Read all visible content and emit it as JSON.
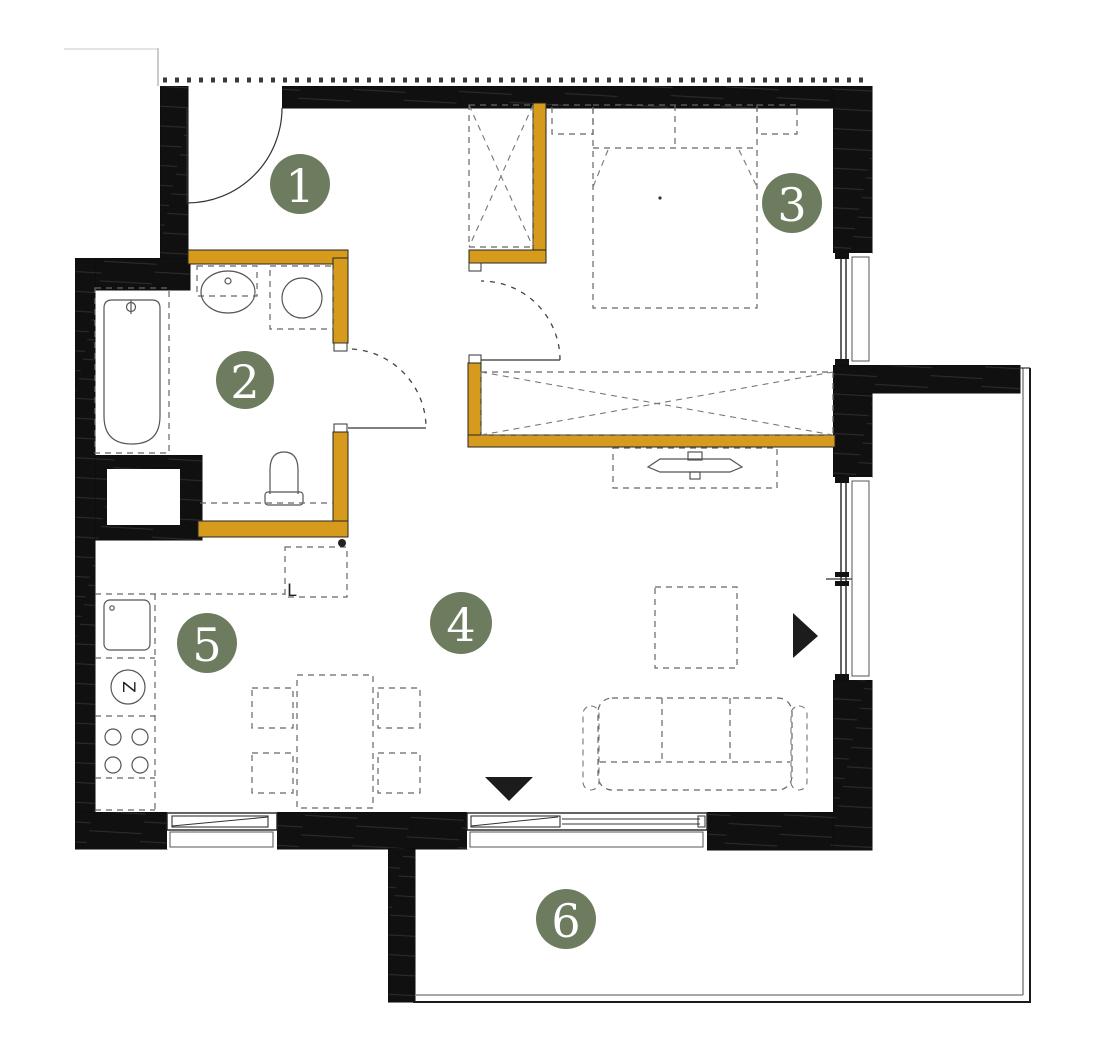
{
  "plan": {
    "rooms": [
      {
        "number": "1"
      },
      {
        "number": "2"
      },
      {
        "number": "3"
      },
      {
        "number": "4"
      },
      {
        "number": "5"
      },
      {
        "number": "6"
      }
    ],
    "annotations": {
      "fridge_label": "L",
      "dishwasher_label": "Z"
    },
    "colors": {
      "exterior_wall": "#111111",
      "accent_wall": "#D69A1C",
      "room_marker": "#6D7C5E",
      "marker_number": "#FFFFFF"
    }
  }
}
